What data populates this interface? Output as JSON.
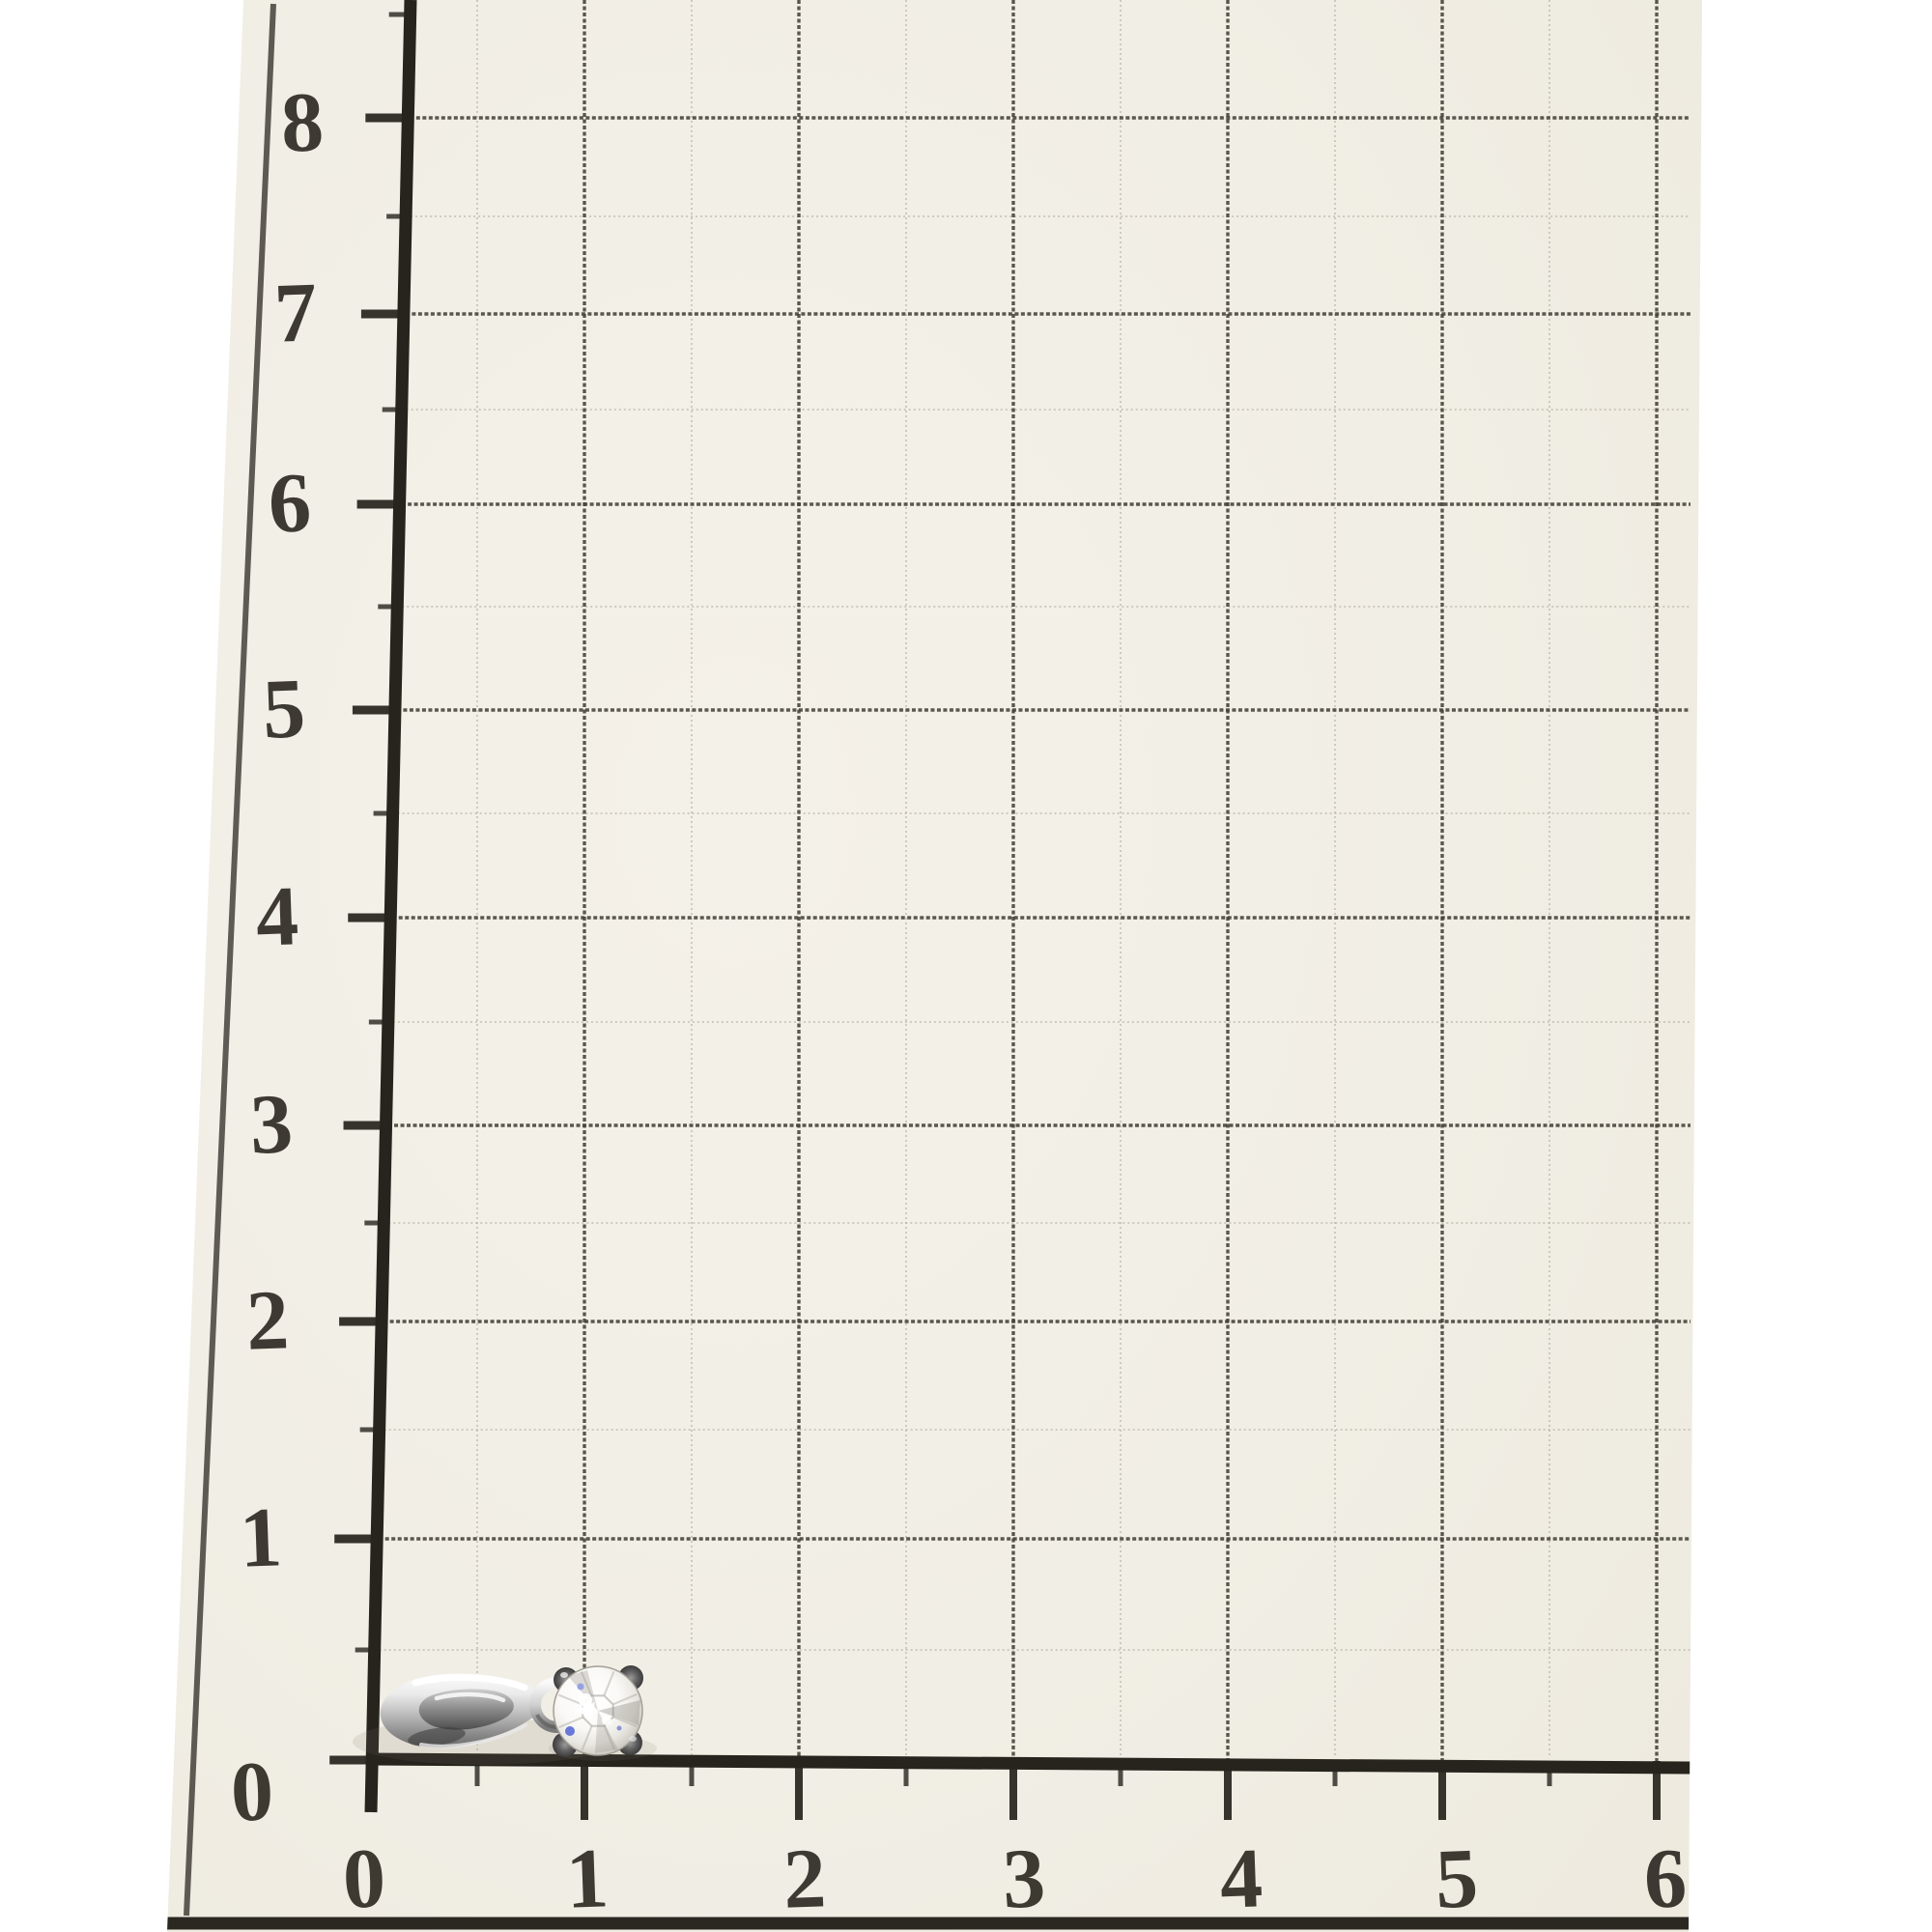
{
  "scene": {
    "subject": "diamond solitaire pendant lying on a centimeter measurement grid board"
  },
  "ruler": {
    "y_axis_labels": [
      "8",
      "7",
      "6",
      "5",
      "4",
      "3",
      "2",
      "1",
      "0"
    ],
    "x_axis_labels": [
      "0",
      "1",
      "2",
      "3",
      "4",
      "5",
      "6"
    ],
    "colors": {
      "paper": "#f2efe6",
      "grid_line": "#46423a",
      "half_line": "#b3ac9c",
      "axis": "#27241e",
      "border": "#45403a",
      "label": "#2f2b24"
    }
  },
  "pendant": {
    "type": "diamond-solitaire-pendant",
    "colors": {
      "metal_highlight": "#ffffff",
      "metal_light": "#ebebeb",
      "metal_mid": "#bdbdbd",
      "metal_dark": "#8f8f8f",
      "metal_shadow": "#666666",
      "prong": "#3b3b3b",
      "stone": "#ffffff",
      "stone_facet": "#8e8b84",
      "glint_blue": "#5a6cd6"
    }
  }
}
